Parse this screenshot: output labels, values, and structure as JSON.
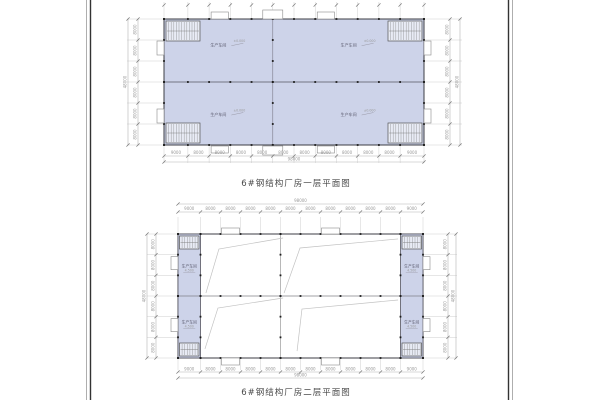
{
  "sheet": {
    "plan1": {
      "title": "6#钢结构厂房一层平面图",
      "room_labels": [
        "生产车间",
        "生产车间",
        "生产车间",
        "生产车间"
      ],
      "level_mark": "±0.000"
    },
    "plan2": {
      "title": "6#钢结构厂房二层平面图",
      "room_labels": [
        "生产车间",
        "生产车间",
        "生产车间",
        "生产车间"
      ],
      "level_mark": "4.500"
    },
    "dimensions": {
      "horizontal_segments": [
        "9000",
        "8000",
        "8000",
        "8000",
        "8000",
        "8000",
        "8000",
        "8000",
        "8000",
        "8000",
        "8000",
        "9000"
      ],
      "horizontal_total": "98000",
      "vertical_segments": [
        "8000",
        "8000",
        "8000",
        "8000",
        "8000",
        "8000"
      ],
      "vertical_total": "48000"
    }
  },
  "colors": {
    "floor_fill": "#cdd3e9",
    "wall_line": "#3c3c44",
    "grid_line": "#c9c9c9",
    "dim_line": "#b5b5b5",
    "dim_text": "#9a9a9a",
    "label_text": "#5a5a6e",
    "column_dot": "#1c1c1c",
    "void_line": "#c2c2c2",
    "border_dark": "#333333",
    "border_light": "#9a9a9a",
    "title_text": "#4a4a4a"
  }
}
